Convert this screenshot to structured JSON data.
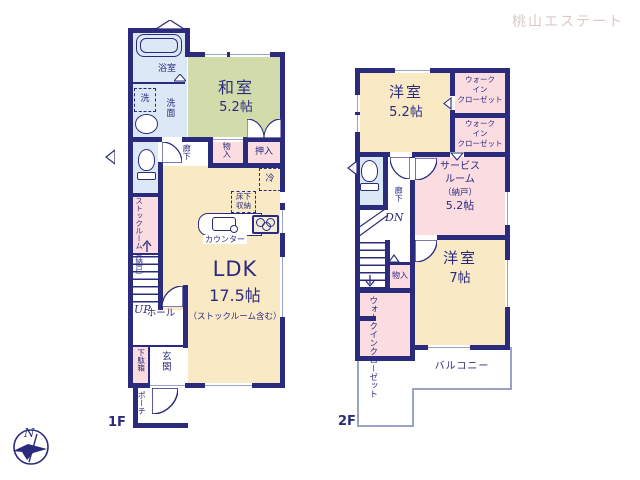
{
  "watermark": "桃山エステート",
  "compass": {
    "north": "N"
  },
  "colors": {
    "wall": "#2b2b7e",
    "ldk_fill": "#f9e9c5",
    "tatami_fill": "#d2dcaa",
    "storage_fill": "#fbdce0",
    "wet_area_fill": "#dbe8f5",
    "watermark": "#d8cac6"
  },
  "f1": {
    "label": "1F",
    "bath": "浴室",
    "laundry": "洗",
    "washroom": "洗面",
    "washitsu": {
      "name": "和室",
      "size": "5.2帖"
    },
    "hallway": "廊下",
    "storage_small": "物入",
    "oshiire": "押入",
    "fridge": "冷",
    "floor_storage": [
      "床下",
      "収納"
    ],
    "counter": "カウンター",
    "stockroom": {
      "name": "ストックルーム",
      "sub": "（納戸）"
    },
    "up": "UP",
    "hall": "ホール",
    "shoe_cabinet": "下駄箱",
    "genkan": "玄関",
    "porch": "ポーチ",
    "ldk": {
      "name": "LDK",
      "size": "17.5帖",
      "note": "（ストックルーム含む）"
    }
  },
  "f2": {
    "label": "2F",
    "bedroom1": {
      "name": "洋室",
      "size": "5.2帖"
    },
    "wic_lines": [
      "ウォーク",
      "イン",
      "クローゼット"
    ],
    "service": {
      "l1": "サービス",
      "l2": "ルーム",
      "l3": "（納戸）",
      "size": "5.2帖"
    },
    "hallway": "廊下",
    "dn": "DN",
    "storage_small": "物入",
    "wic_vertical": {
      "col1": "ウォークイン",
      "col2": "クローゼット"
    },
    "bedroom2": {
      "name": "洋室",
      "size": "7帖"
    },
    "balcony": "バルコニー"
  }
}
